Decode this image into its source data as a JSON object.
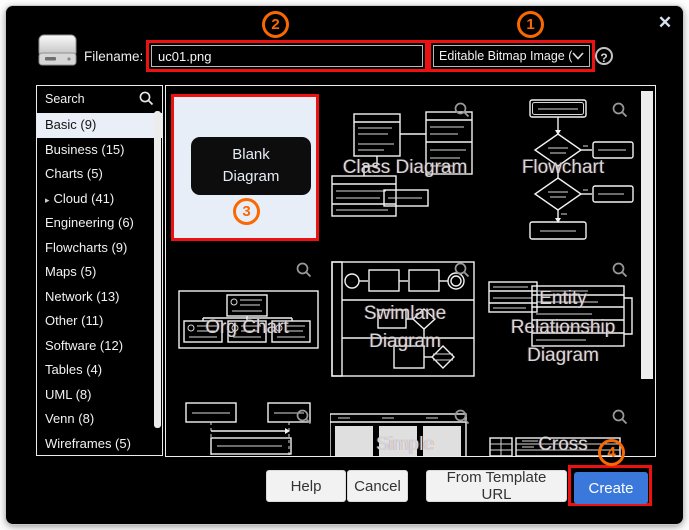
{
  "window": {
    "close_icon": "✕"
  },
  "header": {
    "filename_label": "Filename:",
    "filename_value": "uc01.png",
    "format_value": "Editable Bitmap Image (.p",
    "help_icon": "?"
  },
  "annotations": {
    "n1": "1",
    "n2": "2",
    "n3": "3",
    "n4": "4"
  },
  "sidebar": {
    "search_label": "Search",
    "items": [
      {
        "label": "Basic (9)",
        "selected": true
      },
      {
        "label": "Business (15)"
      },
      {
        "label": "Charts (5)"
      },
      {
        "label": "Cloud (41)",
        "expandable": true
      },
      {
        "label": "Engineering (6)"
      },
      {
        "label": "Flowcharts (9)"
      },
      {
        "label": "Maps (5)"
      },
      {
        "label": "Network (13)"
      },
      {
        "label": "Other (11)"
      },
      {
        "label": "Software (12)"
      },
      {
        "label": "Tables (4)"
      },
      {
        "label": "UML (8)"
      },
      {
        "label": "Venn (8)"
      },
      {
        "label": "Wireframes (5)"
      }
    ]
  },
  "templates": {
    "blank": {
      "label": "Blank Diagram"
    },
    "cells": [
      {
        "name": "class-diagram",
        "label": "Class Diagram"
      },
      {
        "name": "flowchart",
        "label": "Flowchart"
      },
      {
        "name": "org-chart",
        "label": "Org Chart"
      },
      {
        "name": "swimlane-diagram",
        "label": "Swimlane Diagram"
      },
      {
        "name": "entity-relationship-diagram",
        "label": "Entity Relationship Diagram"
      },
      {
        "name": "sequence",
        "label": ""
      },
      {
        "name": "simple",
        "label": "Simple"
      },
      {
        "name": "cross",
        "label": "Cross"
      }
    ]
  },
  "footer": {
    "help": "Help",
    "cancel": "Cancel",
    "from_template_url": "From Template URL",
    "create": "Create"
  },
  "colors": {
    "annotation_red": "#ee1111",
    "annotation_orange": "#fa6800",
    "create_blue": "#3b78dc",
    "selected_item_bg": "#e9eef7",
    "blank_cell_bg": "#e8eef8",
    "dialog_bg": "#000000"
  }
}
